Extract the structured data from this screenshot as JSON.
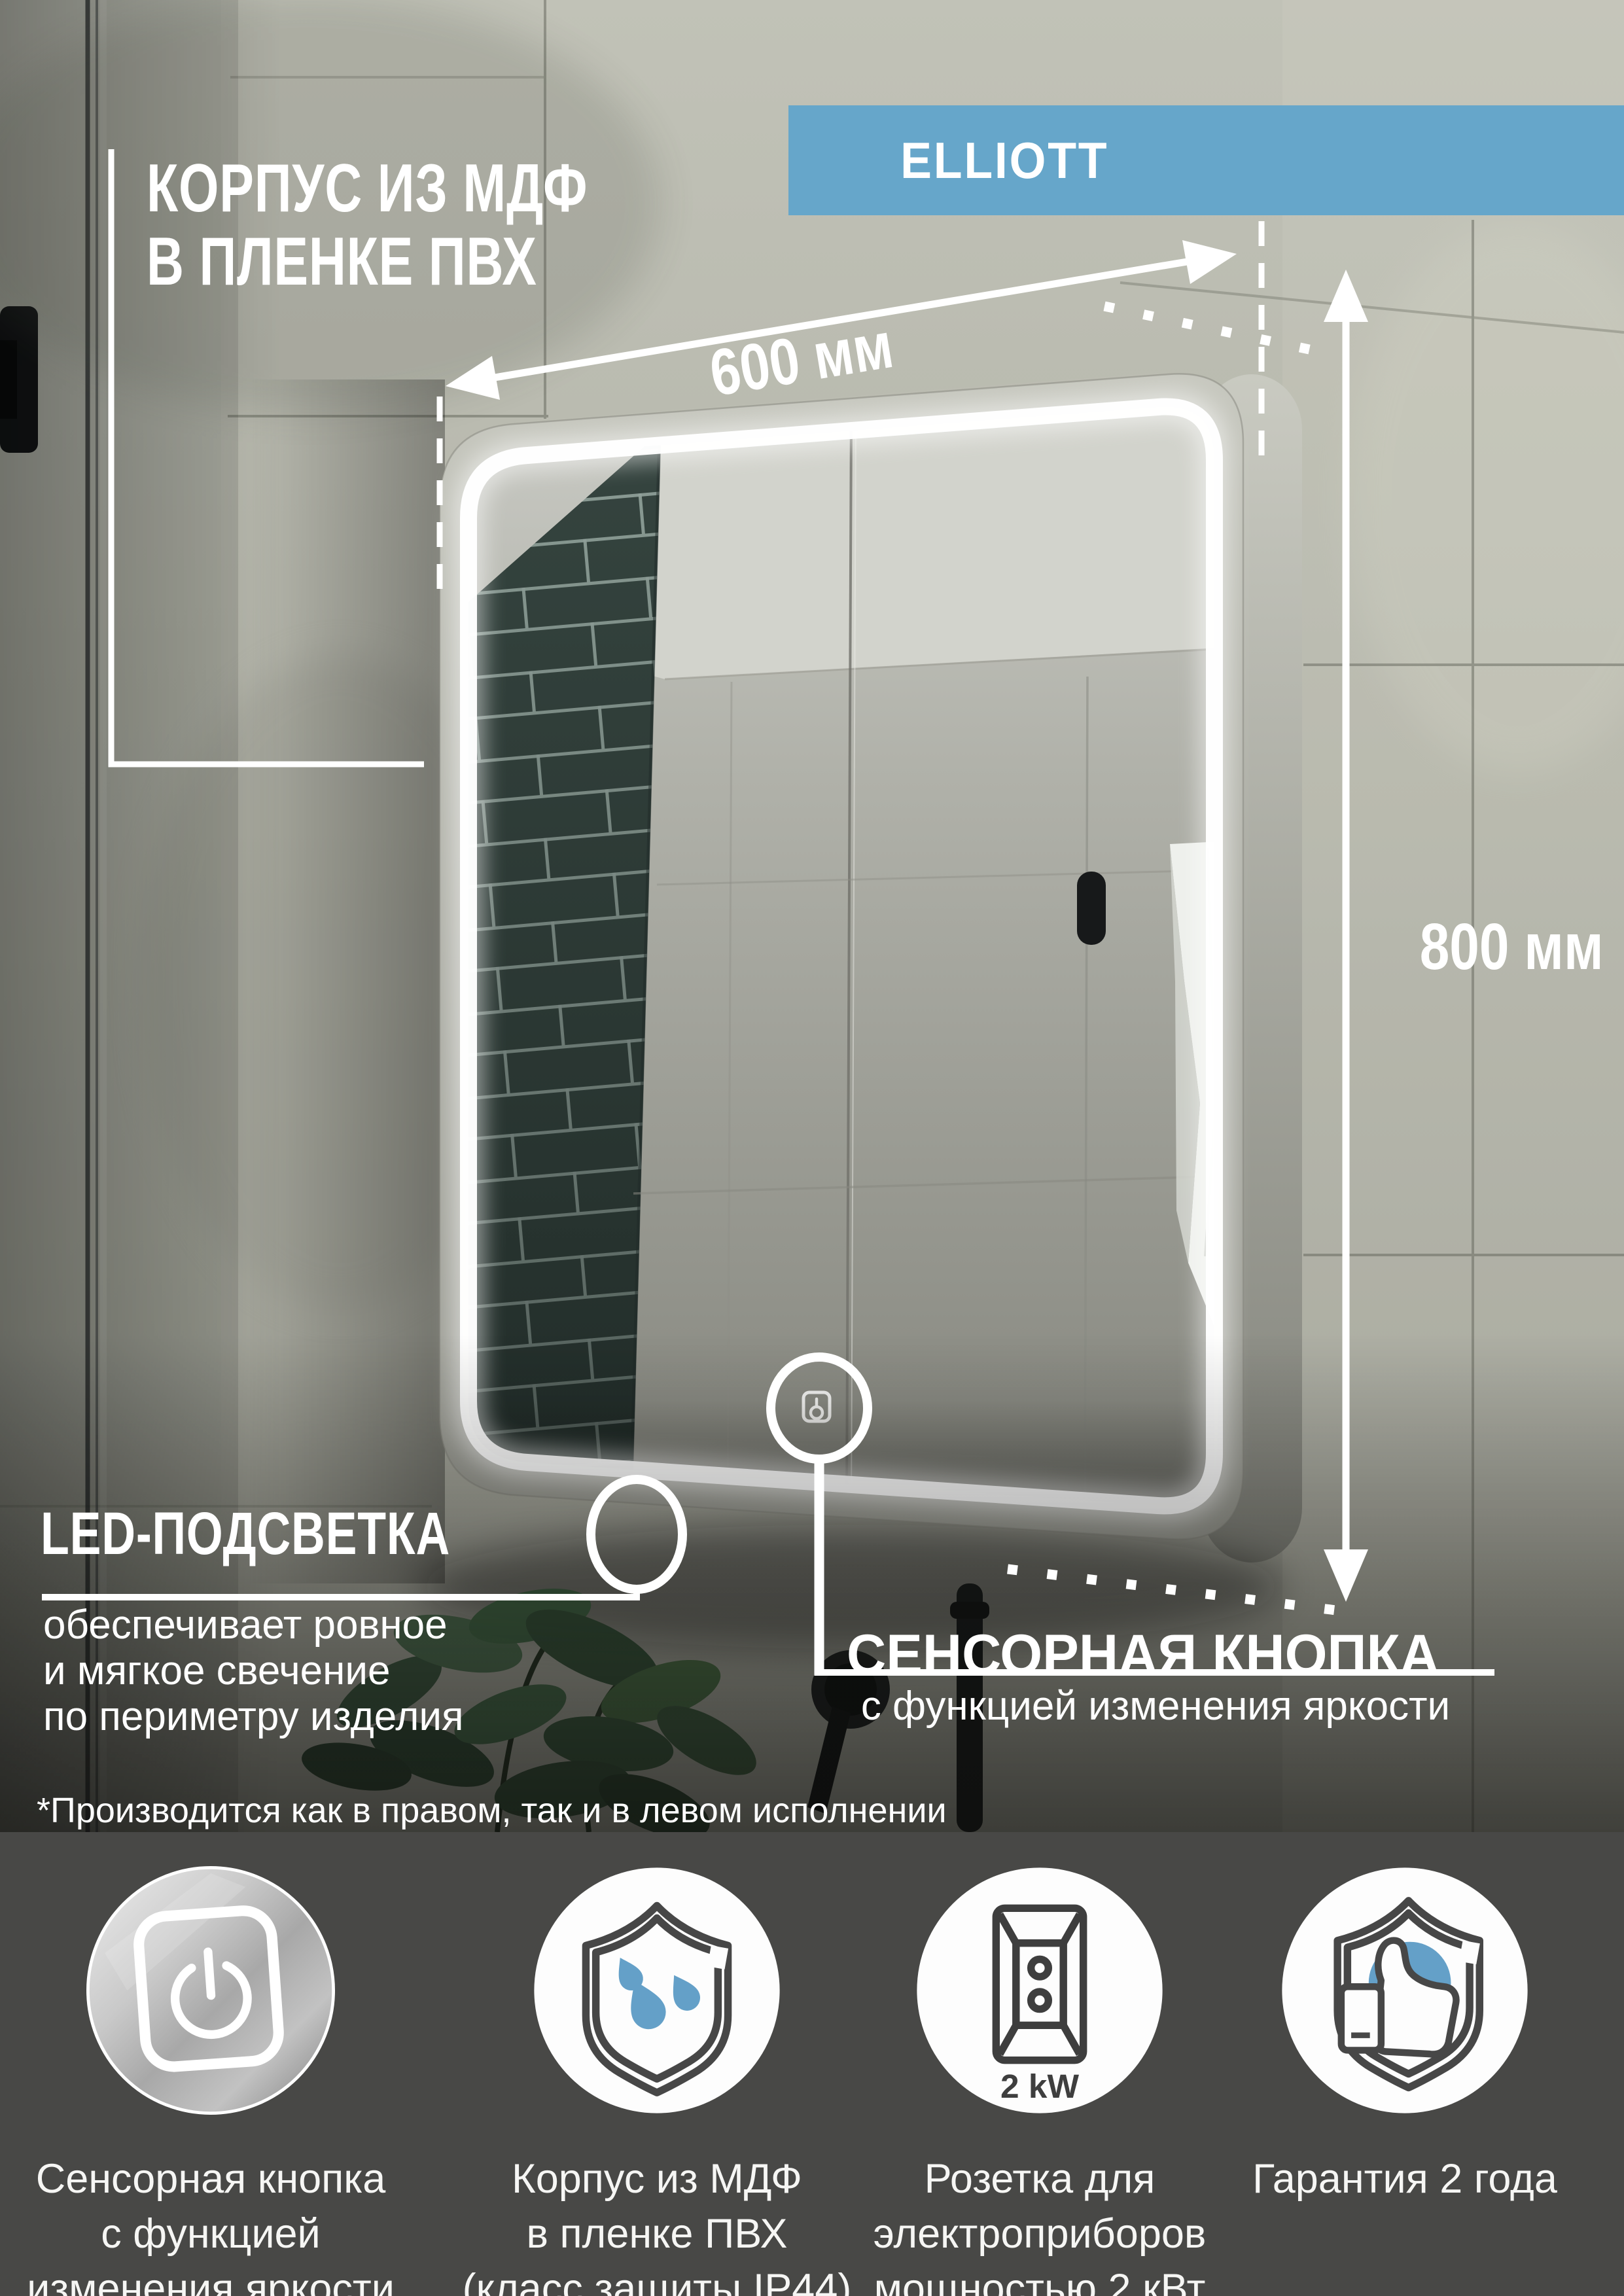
{
  "page": {
    "type": "product-infographic",
    "language": "ru"
  },
  "banner": {
    "model_name": "ELLIOTT"
  },
  "dimensions": {
    "width_label": "600 мм",
    "height_label": "800 мм"
  },
  "callouts": {
    "body_material": {
      "title_line1": "КОРПУС ИЗ МДФ",
      "title_line2": "В ПЛЕНКЕ ПВХ"
    },
    "led": {
      "title": "LED-ПОДСВЕТКА",
      "description_lines": [
        "обеспечивает ровное",
        "и мягкое свечение",
        "по периметру изделия"
      ]
    },
    "sensor_button": {
      "title": "СЕНСОРНАЯ КНОПКА",
      "subtitle": "с функцией изменения яркости"
    }
  },
  "footnote": "*Производится как в правом, так и в левом исполнении",
  "features": [
    {
      "icon": "touch-button-icon",
      "lines": [
        "Сенсорная кнопка",
        "с функцией",
        "изменения яркости"
      ]
    },
    {
      "icon": "shield-water-drops-icon",
      "lines": [
        "Корпус из МДФ",
        "в пленке ПВХ",
        "(класс защиты IP44)"
      ]
    },
    {
      "icon": "power-socket-icon",
      "badge": "2 kW",
      "lines": [
        "Розетка для",
        "электроприборов",
        "мощностью 2 кВт"
      ]
    },
    {
      "icon": "warranty-thumbs-up-shield-icon",
      "lines": [
        "Гарантия 2 года"
      ]
    }
  ],
  "colors": {
    "accent_blue": "#66a6ca",
    "drop_blue": "#64a0c8",
    "footer_bg": "#484846",
    "annotation": "#ffffff"
  }
}
